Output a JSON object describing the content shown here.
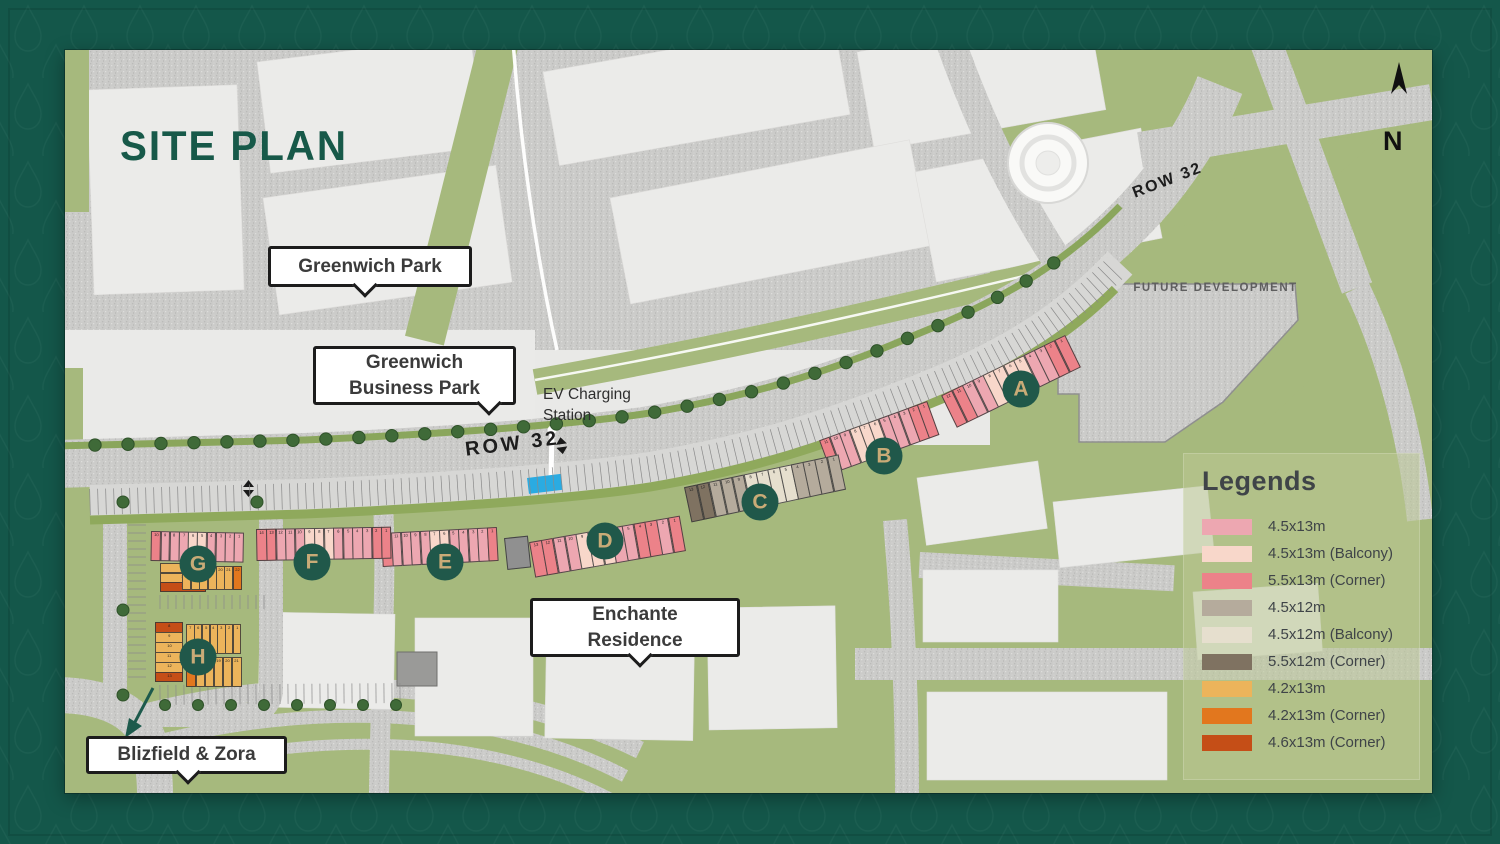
{
  "title": {
    "text": "SITE PLAN"
  },
  "compass": {
    "label": "N"
  },
  "road_labels": {
    "left": "ROW 32",
    "right": "ROW 32"
  },
  "area_labels": {
    "future_development": "FUTURE DEVELOPMENT",
    "ev_station": "EV Charging Station"
  },
  "callouts": {
    "greenwich_park": {
      "label": "Greenwich Park"
    },
    "greenwich_business_park": {
      "label": "Greenwich Business Park"
    },
    "enchante_residence": {
      "label": "Enchante Residence"
    },
    "blizfield_zora": {
      "label": "Blizfield & Zora"
    }
  },
  "legend": {
    "title": "Legends",
    "items": [
      {
        "key": "pink",
        "label": "4.5x13m",
        "color": "#eda7b1"
      },
      {
        "key": "balcony13",
        "label": "4.5x13m (Balcony)",
        "color": "#f8d7ca"
      },
      {
        "key": "corner13",
        "label": "5.5x13m (Corner)",
        "color": "#ec8289"
      },
      {
        "key": "tan",
        "label": "4.5x12m",
        "color": "#b5ab9c"
      },
      {
        "key": "balcony12",
        "label": "4.5x12m (Balcony)",
        "color": "#e6dfce"
      },
      {
        "key": "corner12",
        "label": "5.5x12m (Corner)",
        "color": "#7f7261"
      },
      {
        "key": "amber",
        "label": "4.2x13m",
        "color": "#ecb45b"
      },
      {
        "key": "corner42",
        "label": "4.2x13m (Corner)",
        "color": "#e2771e"
      },
      {
        "key": "corner46",
        "label": "4.6x13m (Corner)",
        "color": "#c54e17"
      }
    ]
  },
  "badges": [
    {
      "id": "A"
    },
    {
      "id": "B"
    },
    {
      "id": "C"
    },
    {
      "id": "D"
    },
    {
      "id": "E"
    },
    {
      "id": "F"
    },
    {
      "id": "G"
    },
    {
      "id": "H"
    }
  ],
  "unit_rows": [
    {
      "id": "aRow",
      "block": "A",
      "cells": [
        {
          "n": 12,
          "k": "corner13"
        },
        {
          "n": 11,
          "k": "corner13"
        },
        {
          "n": 10,
          "k": "pink"
        },
        {
          "n": 9,
          "k": "pink"
        },
        {
          "n": 8,
          "k": "balcony13"
        },
        {
          "n": 7,
          "k": "balcony13"
        },
        {
          "n": 6,
          "k": "balcony13"
        },
        {
          "n": 5,
          "k": "balcony13"
        },
        {
          "n": 4,
          "k": "pink"
        },
        {
          "n": 3,
          "k": "pink"
        },
        {
          "n": 2,
          "k": "corner13"
        },
        {
          "n": 1,
          "k": "corner13"
        }
      ]
    },
    {
      "id": "bRow",
      "block": "B",
      "cells": [
        {
          "n": 11,
          "k": "corner13"
        },
        {
          "n": 10,
          "k": "pink"
        },
        {
          "n": 9,
          "k": "pink"
        },
        {
          "n": 8,
          "k": "balcony13"
        },
        {
          "n": 7,
          "k": "balcony13"
        },
        {
          "n": 6,
          "k": "balcony13"
        },
        {
          "n": 5,
          "k": "pink"
        },
        {
          "n": 4,
          "k": "pink"
        },
        {
          "n": 3,
          "k": "pink"
        },
        {
          "n": 2,
          "k": "corner13"
        },
        {
          "n": 1,
          "k": "corner13"
        }
      ]
    },
    {
      "id": "cRow",
      "block": "C",
      "cells": [
        {
          "n": 13,
          "k": "corner12"
        },
        {
          "n": 12,
          "k": "corner12"
        },
        {
          "n": 11,
          "k": "tan"
        },
        {
          "n": 10,
          "k": "tan"
        },
        {
          "n": 9,
          "k": "tan"
        },
        {
          "n": 8,
          "k": "balcony12"
        },
        {
          "n": 7,
          "k": "balcony12"
        },
        {
          "n": 6,
          "k": "balcony12"
        },
        {
          "n": 5,
          "k": "balcony12"
        },
        {
          "n": 4,
          "k": "tan"
        },
        {
          "n": 3,
          "k": "tan"
        },
        {
          "n": 2,
          "k": "tan"
        },
        {
          "n": 1,
          "k": "tan"
        }
      ]
    },
    {
      "id": "dRow",
      "block": "D",
      "cells": [
        {
          "n": 13,
          "k": "corner13"
        },
        {
          "n": 12,
          "k": "corner13"
        },
        {
          "n": 11,
          "k": "pink"
        },
        {
          "n": 10,
          "k": "pink"
        },
        {
          "n": 9,
          "k": "balcony13"
        },
        {
          "n": 8,
          "k": "balcony13"
        },
        {
          "n": 7,
          "k": "balcony13"
        },
        {
          "n": 6,
          "k": "pink"
        },
        {
          "n": 5,
          "k": "pink"
        },
        {
          "n": 4,
          "k": "corner13"
        },
        {
          "n": 3,
          "k": "corner13"
        },
        {
          "n": 2,
          "k": "pink"
        },
        {
          "n": 1,
          "k": "corner13"
        }
      ]
    },
    {
      "id": "eRow",
      "block": "E",
      "cells": [
        {
          "n": 12,
          "k": "corner13"
        },
        {
          "n": 11,
          "k": "pink"
        },
        {
          "n": 10,
          "k": "pink"
        },
        {
          "n": 9,
          "k": "pink"
        },
        {
          "n": 8,
          "k": "pink"
        },
        {
          "n": 7,
          "k": "balcony13"
        },
        {
          "n": 6,
          "k": "balcony13"
        },
        {
          "n": 5,
          "k": "pink"
        },
        {
          "n": 4,
          "k": "pink"
        },
        {
          "n": 3,
          "k": "pink"
        },
        {
          "n": 2,
          "k": "pink"
        },
        {
          "n": 1,
          "k": "corner13"
        }
      ]
    },
    {
      "id": "fRow",
      "block": "F",
      "cells": [
        {
          "n": 14,
          "k": "corner13"
        },
        {
          "n": 13,
          "k": "corner13"
        },
        {
          "n": 12,
          "k": "pink"
        },
        {
          "n": 11,
          "k": "pink"
        },
        {
          "n": 10,
          "k": "pink"
        },
        {
          "n": 9,
          "k": "balcony13"
        },
        {
          "n": 8,
          "k": "balcony13"
        },
        {
          "n": 7,
          "k": "balcony13"
        },
        {
          "n": 6,
          "k": "pink"
        },
        {
          "n": 5,
          "k": "pink"
        },
        {
          "n": 4,
          "k": "pink"
        },
        {
          "n": 3,
          "k": "pink"
        },
        {
          "n": 2,
          "k": "corner13"
        },
        {
          "n": 1,
          "k": "corner13"
        }
      ]
    },
    {
      "id": "gRow",
      "block": "G",
      "cells": [
        {
          "n": 10,
          "k": "corner13"
        },
        {
          "n": 9,
          "k": "pink"
        },
        {
          "n": 8,
          "k": "pink"
        },
        {
          "n": 7,
          "k": "pink"
        },
        {
          "n": 6,
          "k": "balcony13"
        },
        {
          "n": 5,
          "k": "balcony13"
        },
        {
          "n": 4,
          "k": "pink"
        },
        {
          "n": 3,
          "k": "pink"
        },
        {
          "n": 2,
          "k": "pink"
        },
        {
          "n": 1,
          "k": "pink"
        }
      ]
    },
    {
      "id": "gSide",
      "block": "G",
      "cells": [
        {
          "n": 11,
          "k": "amber"
        },
        {
          "n": 12,
          "k": "amber"
        },
        {
          "n": 13,
          "k": "corner46"
        }
      ]
    },
    {
      "id": "gBottom",
      "block": "G",
      "cells": [
        {
          "n": 16,
          "k": "amber"
        },
        {
          "n": 17,
          "k": "amber"
        },
        {
          "n": 18,
          "k": "amber"
        },
        {
          "n": 19,
          "k": "amber"
        },
        {
          "n": 20,
          "k": "amber"
        },
        {
          "n": 21,
          "k": "amber"
        },
        {
          "n": 22,
          "k": "corner42"
        }
      ]
    },
    {
      "id": "hLeft",
      "block": "H",
      "cells": [
        {
          "n": 8,
          "k": "corner46"
        },
        {
          "n": 9,
          "k": "amber"
        },
        {
          "n": 10,
          "k": "amber"
        },
        {
          "n": 11,
          "k": "amber"
        },
        {
          "n": 12,
          "k": "amber"
        },
        {
          "n": 13,
          "k": "corner46"
        }
      ]
    },
    {
      "id": "hTop",
      "block": "H",
      "cells": [
        {
          "n": 7,
          "k": "amber"
        },
        {
          "n": 6,
          "k": "amber"
        },
        {
          "n": 5,
          "k": "amber"
        },
        {
          "n": 4,
          "k": "amber"
        },
        {
          "n": 3,
          "k": "amber"
        },
        {
          "n": 2,
          "k": "amber"
        },
        {
          "n": 1,
          "k": "amber"
        }
      ]
    },
    {
      "id": "hBottom",
      "block": "H",
      "cells": [
        {
          "n": 16,
          "k": "corner42"
        },
        {
          "n": 17,
          "k": "amber"
        },
        {
          "n": 18,
          "k": "amber"
        },
        {
          "n": 19,
          "k": "amber"
        },
        {
          "n": 20,
          "k": "amber"
        },
        {
          "n": 21,
          "k": "amber"
        }
      ]
    },
    {
      "id": "utility",
      "block": "",
      "cells": [
        {
          "n": null,
          "k": "utility"
        }
      ]
    }
  ],
  "extra_colors": {
    "utility": "#909090",
    "ev_blue": "#2aabe2",
    "badge_teal": "#20584a",
    "badge_letter": "#c9ab77"
  }
}
